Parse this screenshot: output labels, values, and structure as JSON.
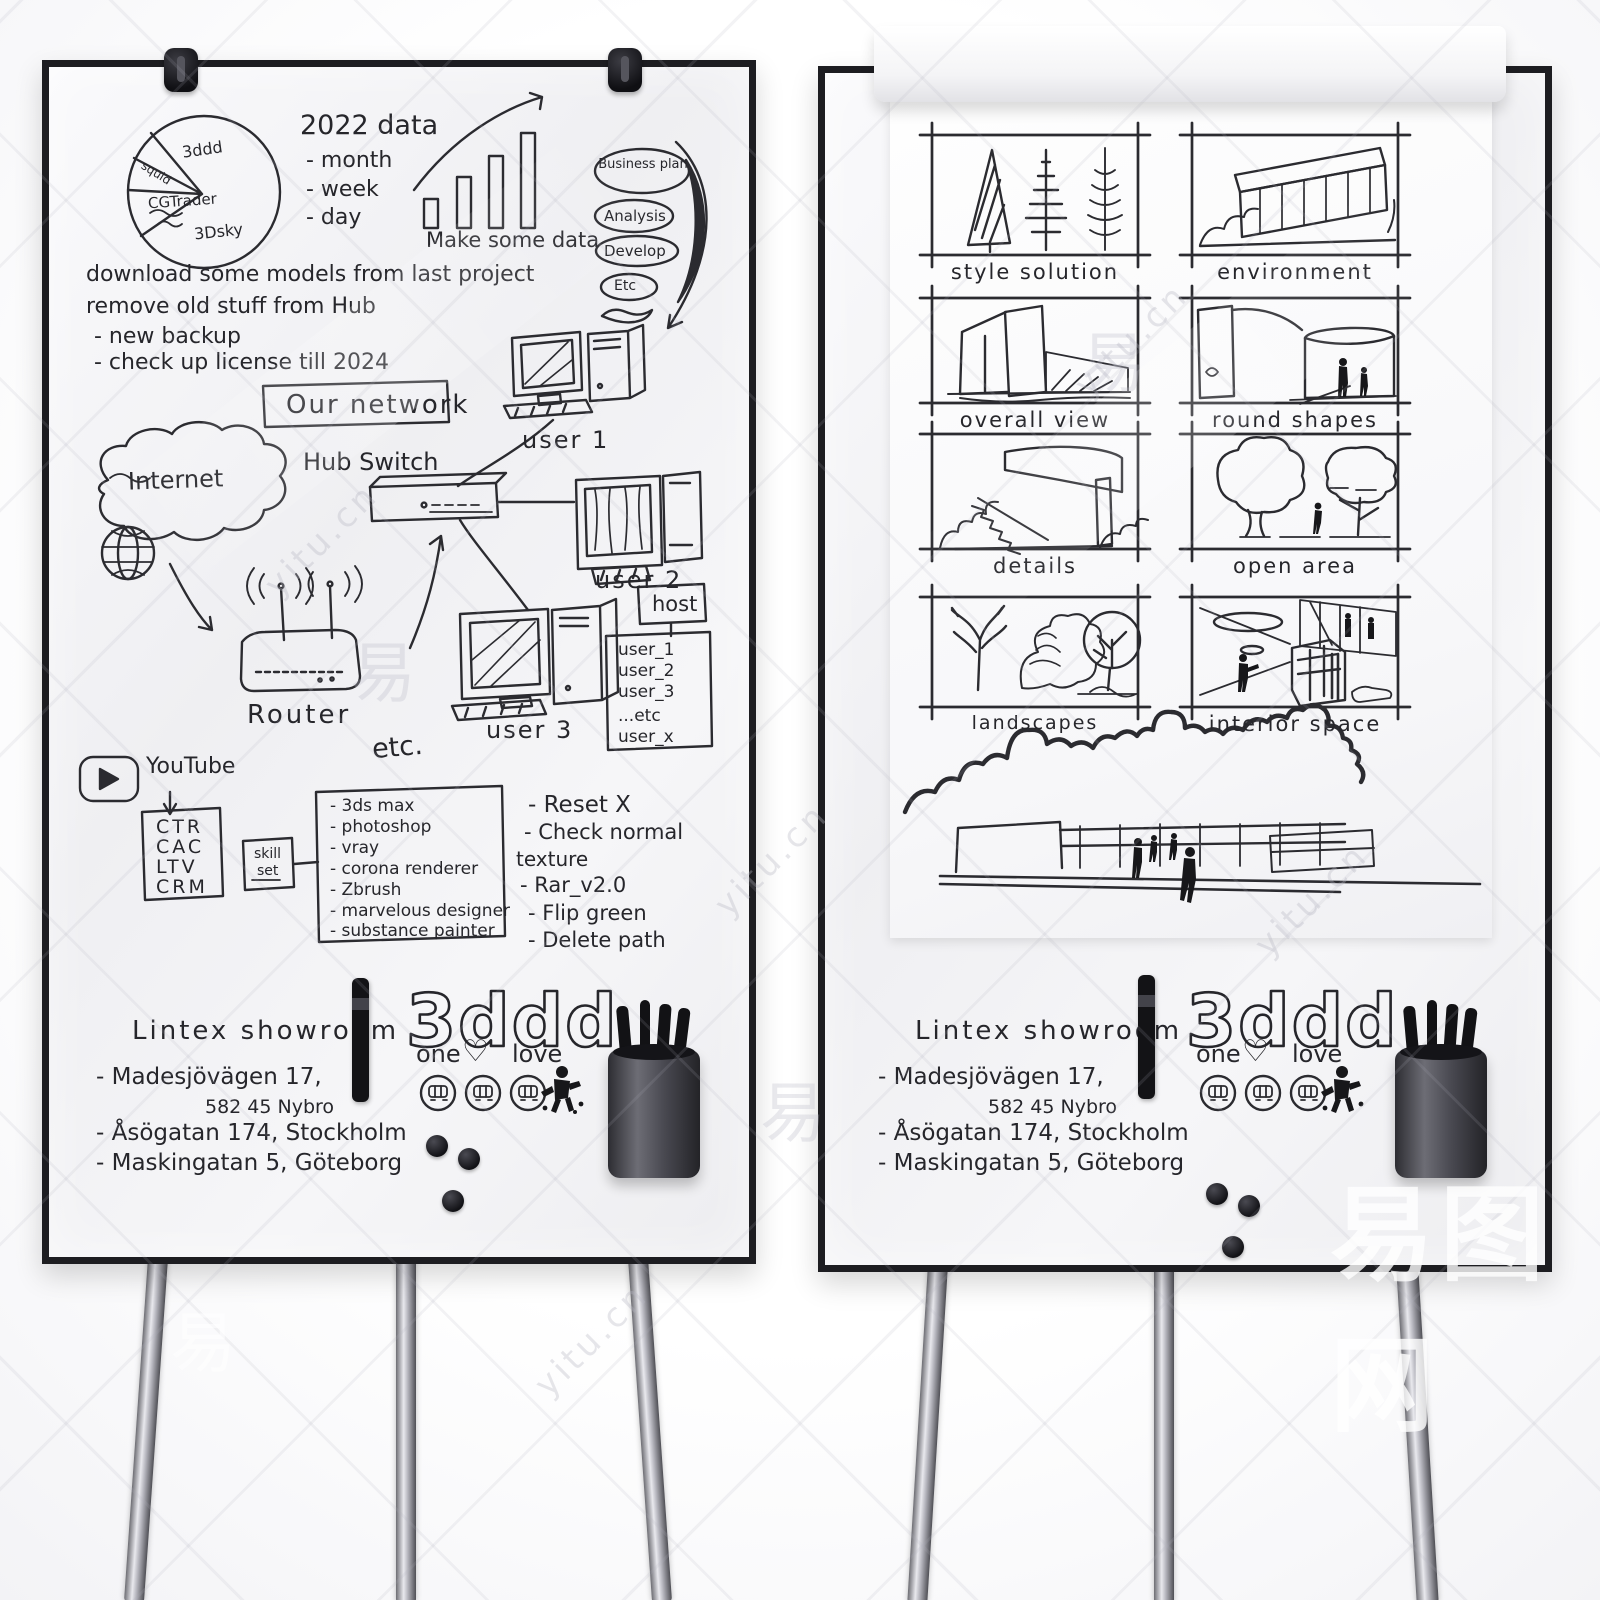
{
  "watermark": {
    "site": "yitu.cn",
    "brand": "易图网",
    "char": "易"
  },
  "logo": {
    "name": "3ddd",
    "one": "one",
    "heart": "♡",
    "love": "love"
  },
  "showroom": {
    "title": "Lintex showroom",
    "addr1": "- Madesjövägen 17,",
    "addr1b": "582 45 Nybro",
    "addr2": "- Åsögatan 174, Stockholm",
    "addr3": "- Maskingatan 5, Göteborg"
  },
  "left_board": {
    "pie_labels": {
      "top": "3ddd",
      "left": "squid",
      "mid": "CGTrader",
      "bottom": "3Dsky"
    },
    "data2022": {
      "title": "2022 data",
      "m": "- month",
      "w": "- week",
      "d": "- day"
    },
    "bar_caption": "Make some data",
    "funnel": {
      "e1": "Business plan",
      "e2": "Analysis",
      "e3": "Develop",
      "e4": "Etc"
    },
    "notes": {
      "n1": "download some models from last project",
      "n2": "remove old stuff from Hub",
      "n3": "- new backup",
      "n4": "- check up license till 2024"
    },
    "network": {
      "title": "Our network",
      "hub": "Hub Switch",
      "internet": "Internet",
      "router": "Router",
      "u1": "user 1",
      "u2": "user 2",
      "u3": "user 3",
      "host": "host",
      "h1": "user_1",
      "h2": "user_2",
      "h3": "user_3",
      "h4": "...etc",
      "h5": "user_x"
    },
    "etc_title": "etc.",
    "youtube": "YouTube",
    "metrics": {
      "m1": "CTR",
      "m2": "CAC",
      "m3": "LTV",
      "m4": "CRM"
    },
    "skill": {
      "l1": "skill",
      "l2": "set"
    },
    "software": {
      "s1": "- 3ds max",
      "s2": "- photoshop",
      "s3": "- vray",
      "s4": "- corona renderer",
      "s5": "- Zbrush",
      "s6": "- marvelous designer",
      "s7": "- substance painter"
    },
    "todo": {
      "t1": "- Reset X",
      "t2": "- Check normal",
      "t3": "texture",
      "t4": "- Rar_v2.0",
      "t5": "- Flip green",
      "t6": "- Delete path"
    }
  },
  "right_board": {
    "panels": {
      "p1": "style solution",
      "p2": "environment",
      "p3": "overall view",
      "p4": "round shapes",
      "p5": "details",
      "p6": "open area",
      "p7": "landscapes",
      "p8": "interior space"
    }
  }
}
